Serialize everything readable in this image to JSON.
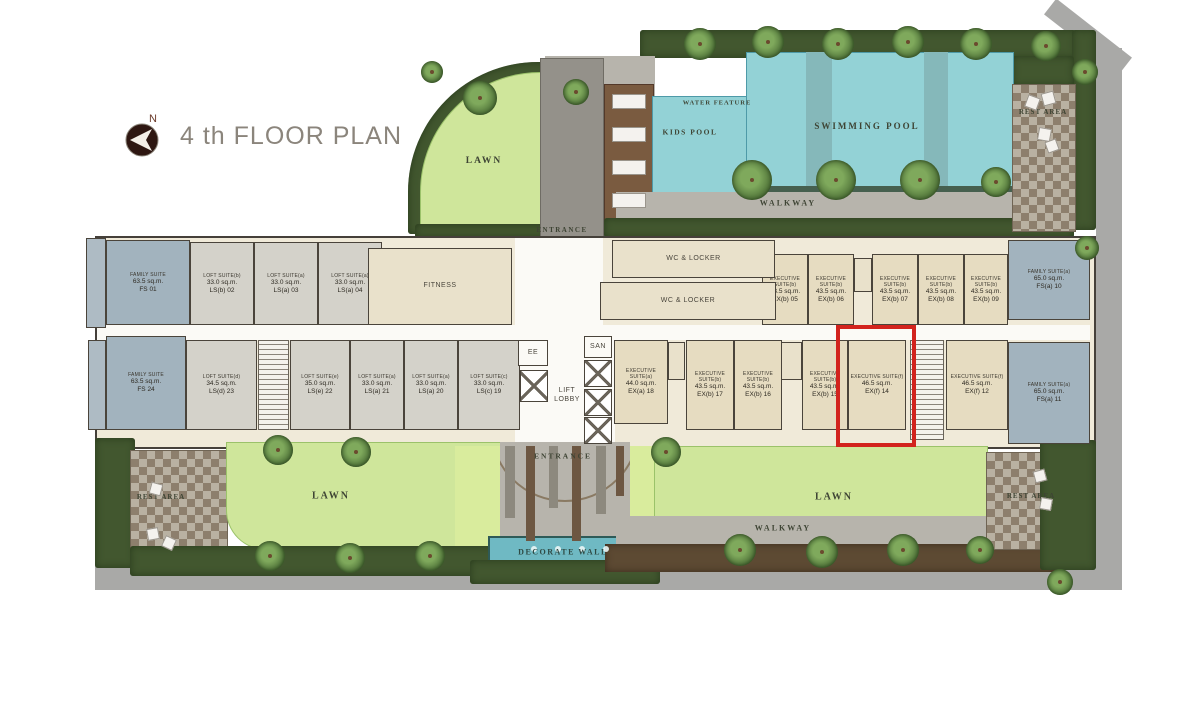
{
  "title": {
    "text": "4 th FLOOR PLAN",
    "compass": "N"
  },
  "highlight": {
    "x": 836,
    "y": 325,
    "w": 80,
    "h": 122,
    "color": "#d2231d"
  },
  "units": [
    {
      "code": "FS 01",
      "name": "FAMILY SUITE",
      "area": "63.5 sq.m.",
      "style": "family",
      "x": 106,
      "y": 240,
      "w": 84,
      "h": 85
    },
    {
      "code": "LS(b) 02",
      "name": "LOFT SUITE(b)",
      "area": "33.0 sq.m.",
      "style": "loft",
      "x": 190,
      "y": 242,
      "w": 64,
      "h": 83
    },
    {
      "code": "LS(a) 03",
      "name": "LOFT SUITE(a)",
      "area": "33.0 sq.m.",
      "style": "loft",
      "x": 254,
      "y": 242,
      "w": 64,
      "h": 83
    },
    {
      "code": "LS(a) 04",
      "name": "LOFT SUITE(a)",
      "area": "33.0 sq.m.",
      "style": "loft",
      "x": 318,
      "y": 242,
      "w": 64,
      "h": 83
    },
    {
      "code": "EX(b) 05",
      "name": "EXECUTIVE SUITE(b)",
      "area": "43.5 sq.m.",
      "style": "exec",
      "x": 762,
      "y": 254,
      "w": 46,
      "h": 71
    },
    {
      "code": "EX(b) 06",
      "name": "EXECUTIVE SUITE(b)",
      "area": "43.5 sq.m.",
      "style": "exec",
      "x": 808,
      "y": 254,
      "w": 46,
      "h": 71
    },
    {
      "code": "EX(b) 07",
      "name": "EXECUTIVE SUITE(b)",
      "area": "43.5 sq.m.",
      "style": "exec",
      "x": 872,
      "y": 254,
      "w": 46,
      "h": 71
    },
    {
      "code": "EX(b) 08",
      "name": "EXECUTIVE SUITE(b)",
      "area": "43.5 sq.m.",
      "style": "exec",
      "x": 918,
      "y": 254,
      "w": 46,
      "h": 71
    },
    {
      "code": "EX(b) 09",
      "name": "EXECUTIVE SUITE(b)",
      "area": "43.5 sq.m.",
      "style": "exec",
      "x": 964,
      "y": 254,
      "w": 44,
      "h": 71
    },
    {
      "code": "FS(a) 10",
      "name": "FAMILY SUITE(a)",
      "area": "65.0 sq.m.",
      "style": "family",
      "x": 1008,
      "y": 240,
      "w": 82,
      "h": 80
    },
    {
      "code": "FS 24",
      "name": "FAMILY SUITE",
      "area": "63.5 sq.m.",
      "style": "family",
      "x": 106,
      "y": 336,
      "w": 80,
      "h": 94
    },
    {
      "code": "LS(d) 23",
      "name": "LOFT SUITE(d)",
      "area": "34.5 sq.m.",
      "style": "loft",
      "x": 186,
      "y": 340,
      "w": 71,
      "h": 90
    },
    {
      "code": "LS(e) 22",
      "name": "LOFT SUITE(e)",
      "area": "35.0 sq.m.",
      "style": "loft",
      "x": 290,
      "y": 340,
      "w": 60,
      "h": 90
    },
    {
      "code": "LS(a) 21",
      "name": "LOFT SUITE(a)",
      "area": "33.0 sq.m.",
      "style": "loft",
      "x": 350,
      "y": 340,
      "w": 54,
      "h": 90
    },
    {
      "code": "LS(a) 20",
      "name": "LOFT SUITE(a)",
      "area": "33.0 sq.m.",
      "style": "loft",
      "x": 404,
      "y": 340,
      "w": 54,
      "h": 90
    },
    {
      "code": "LS(c) 19",
      "name": "LOFT SUITE(c)",
      "area": "33.0 sq.m.",
      "style": "loft",
      "x": 458,
      "y": 340,
      "w": 62,
      "h": 90
    },
    {
      "code": "EX(a) 18",
      "name": "EXECUTIVE SUITE(a)",
      "area": "44.0 sq.m.",
      "style": "exec",
      "x": 614,
      "y": 340,
      "w": 54,
      "h": 84
    },
    {
      "code": "EX(b) 17",
      "name": "EXECUTIVE SUITE(b)",
      "area": "43.5 sq.m.",
      "style": "exec",
      "x": 686,
      "y": 340,
      "w": 48,
      "h": 90
    },
    {
      "code": "EX(b) 16",
      "name": "EXECUTIVE SUITE(b)",
      "area": "43.5 sq.m.",
      "style": "exec",
      "x": 734,
      "y": 340,
      "w": 48,
      "h": 90
    },
    {
      "code": "EX(b) 15",
      "name": "EXECUTIVE SUITE(b)",
      "area": "43.5 sq.m.",
      "style": "exec",
      "x": 802,
      "y": 340,
      "w": 46,
      "h": 90
    },
    {
      "code": "EX(f) 14",
      "name": "EXECUTIVE SUITE(f)",
      "area": "46.5 sq.m.",
      "style": "exec",
      "x": 848,
      "y": 340,
      "w": 58,
      "h": 90
    },
    {
      "code": "EX(f) 12",
      "name": "EXECUTIVE SUITE(f)",
      "area": "46.5 sq.m.",
      "style": "exec",
      "x": 946,
      "y": 340,
      "w": 62,
      "h": 90
    },
    {
      "code": "FS(a) 11",
      "name": "FAMILY SUITE(a)",
      "area": "65.0 sq.m.",
      "style": "family",
      "x": 1008,
      "y": 342,
      "w": 82,
      "h": 102
    },
    {
      "code": "SV A",
      "style": "service",
      "x": 86,
      "y": 238,
      "w": 20,
      "h": 90
    },
    {
      "code": "SV B",
      "style": "service",
      "x": 88,
      "y": 340,
      "w": 18,
      "h": 90
    }
  ],
  "rooms": [
    {
      "label": "FITNESS",
      "style": "cream",
      "x": 368,
      "y": 248,
      "w": 144,
      "h": 77
    },
    {
      "label": "WC & LOCKER",
      "style": "cream",
      "x": 612,
      "y": 240,
      "w": 163,
      "h": 38
    },
    {
      "label": "WC & LOCKER",
      "style": "cream",
      "x": 600,
      "y": 282,
      "w": 176,
      "h": 38
    },
    {
      "label": "EE",
      "style": "white",
      "x": 518,
      "y": 340,
      "w": 30,
      "h": 26
    },
    {
      "label": "SAN",
      "style": "white",
      "x": 584,
      "y": 336,
      "w": 28,
      "h": 22
    },
    {
      "label": "LIFT\nLOBBY",
      "style": "ghost",
      "x": 548,
      "y": 368,
      "w": 38,
      "h": 56
    }
  ],
  "labels": [
    {
      "text": "WATER FEATURE",
      "x": 717,
      "y": 103,
      "size": 6.5,
      "ls": 1
    },
    {
      "text": "KIDS POOL",
      "x": 690,
      "y": 132,
      "size": 7.5,
      "ls": 1.5
    },
    {
      "text": "SWIMMING POOL",
      "x": 867,
      "y": 126,
      "size": 9,
      "ls": 2
    },
    {
      "text": "REST AREA",
      "x": 1043,
      "y": 112,
      "size": 7,
      "ls": 1
    },
    {
      "text": "WALKWAY",
      "x": 788,
      "y": 203,
      "size": 8,
      "ls": 2
    },
    {
      "text": "ENTRANCE",
      "x": 562,
      "y": 230,
      "size": 7,
      "ls": 1.5
    },
    {
      "text": "LAWN",
      "x": 484,
      "y": 161,
      "size": 9.5,
      "ls": 2
    },
    {
      "text": "LAWN",
      "x": 331,
      "y": 496,
      "size": 10,
      "ls": 2
    },
    {
      "text": "LAWN",
      "x": 834,
      "y": 497,
      "size": 10,
      "ls": 2
    },
    {
      "text": "WALKWAY",
      "x": 783,
      "y": 528,
      "size": 8,
      "ls": 2
    },
    {
      "text": "REST AREA",
      "x": 161,
      "y": 497,
      "size": 7,
      "ls": 1
    },
    {
      "text": "REST AREA",
      "x": 1031,
      "y": 496,
      "size": 7,
      "ls": 1
    },
    {
      "text": "ENTRANCE",
      "x": 563,
      "y": 456,
      "size": 7.5,
      "ls": 2
    },
    {
      "text": "DECORATE WALL",
      "x": 563,
      "y": 552,
      "size": 8,
      "ls": 1.5,
      "color": "#2f4a44"
    }
  ],
  "decor": {
    "trees": [
      [
        700,
        44,
        16
      ],
      [
        768,
        42,
        16
      ],
      [
        838,
        44,
        16
      ],
      [
        908,
        42,
        16
      ],
      [
        976,
        44,
        16
      ],
      [
        1046,
        46,
        15
      ],
      [
        1085,
        72,
        13
      ],
      [
        752,
        180,
        20
      ],
      [
        836,
        180,
        20
      ],
      [
        920,
        180,
        20
      ],
      [
        996,
        182,
        15
      ],
      [
        480,
        98,
        17
      ],
      [
        576,
        92,
        13
      ],
      [
        432,
        72,
        11
      ],
      [
        278,
        450,
        15
      ],
      [
        356,
        452,
        15
      ],
      [
        666,
        452,
        15
      ],
      [
        270,
        556,
        15
      ],
      [
        350,
        558,
        15
      ],
      [
        430,
        556,
        15
      ],
      [
        740,
        550,
        16
      ],
      [
        822,
        552,
        16
      ],
      [
        903,
        550,
        16
      ],
      [
        980,
        550,
        14
      ],
      [
        1060,
        582,
        13
      ],
      [
        1087,
        248,
        12
      ]
    ],
    "loungers": [
      [
        612,
        94,
        34,
        15,
        0
      ],
      [
        612,
        127,
        34,
        15,
        0
      ],
      [
        612,
        160,
        34,
        15,
        0
      ],
      [
        612,
        193,
        34,
        15,
        0
      ],
      [
        1026,
        96,
        13,
        13,
        20
      ],
      [
        1042,
        92,
        13,
        13,
        -15
      ],
      [
        1038,
        128,
        13,
        13,
        10
      ],
      [
        1046,
        140,
        12,
        12,
        -20
      ],
      [
        150,
        483,
        12,
        12,
        15
      ],
      [
        147,
        528,
        12,
        12,
        -10
      ],
      [
        163,
        537,
        12,
        12,
        25
      ],
      [
        1034,
        470,
        12,
        12,
        -15
      ],
      [
        1040,
        498,
        12,
        12,
        10
      ]
    ],
    "shafts": [
      [
        520,
        370,
        28,
        32
      ],
      [
        584,
        360,
        28,
        27
      ],
      [
        584,
        389,
        28,
        27
      ],
      [
        584,
        417,
        28,
        27
      ]
    ],
    "stairs": [
      [
        258,
        340,
        31,
        90
      ],
      [
        910,
        340,
        34,
        100
      ]
    ],
    "cores": [
      [
        854,
        258,
        18,
        34
      ],
      [
        668,
        342,
        17,
        38
      ],
      [
        780,
        342,
        22,
        38
      ]
    ],
    "bars": [
      [
        505,
        446,
        10,
        72,
        "g"
      ],
      [
        526,
        446,
        9,
        95,
        "b"
      ],
      [
        549,
        446,
        9,
        62,
        "g"
      ],
      [
        572,
        446,
        9,
        95,
        "b"
      ],
      [
        596,
        446,
        10,
        68,
        "g"
      ],
      [
        616,
        446,
        8,
        50,
        "b"
      ]
    ],
    "dots": [
      [
        531,
        546
      ],
      [
        555,
        546
      ],
      [
        579,
        546
      ],
      [
        603,
        546
      ]
    ]
  }
}
